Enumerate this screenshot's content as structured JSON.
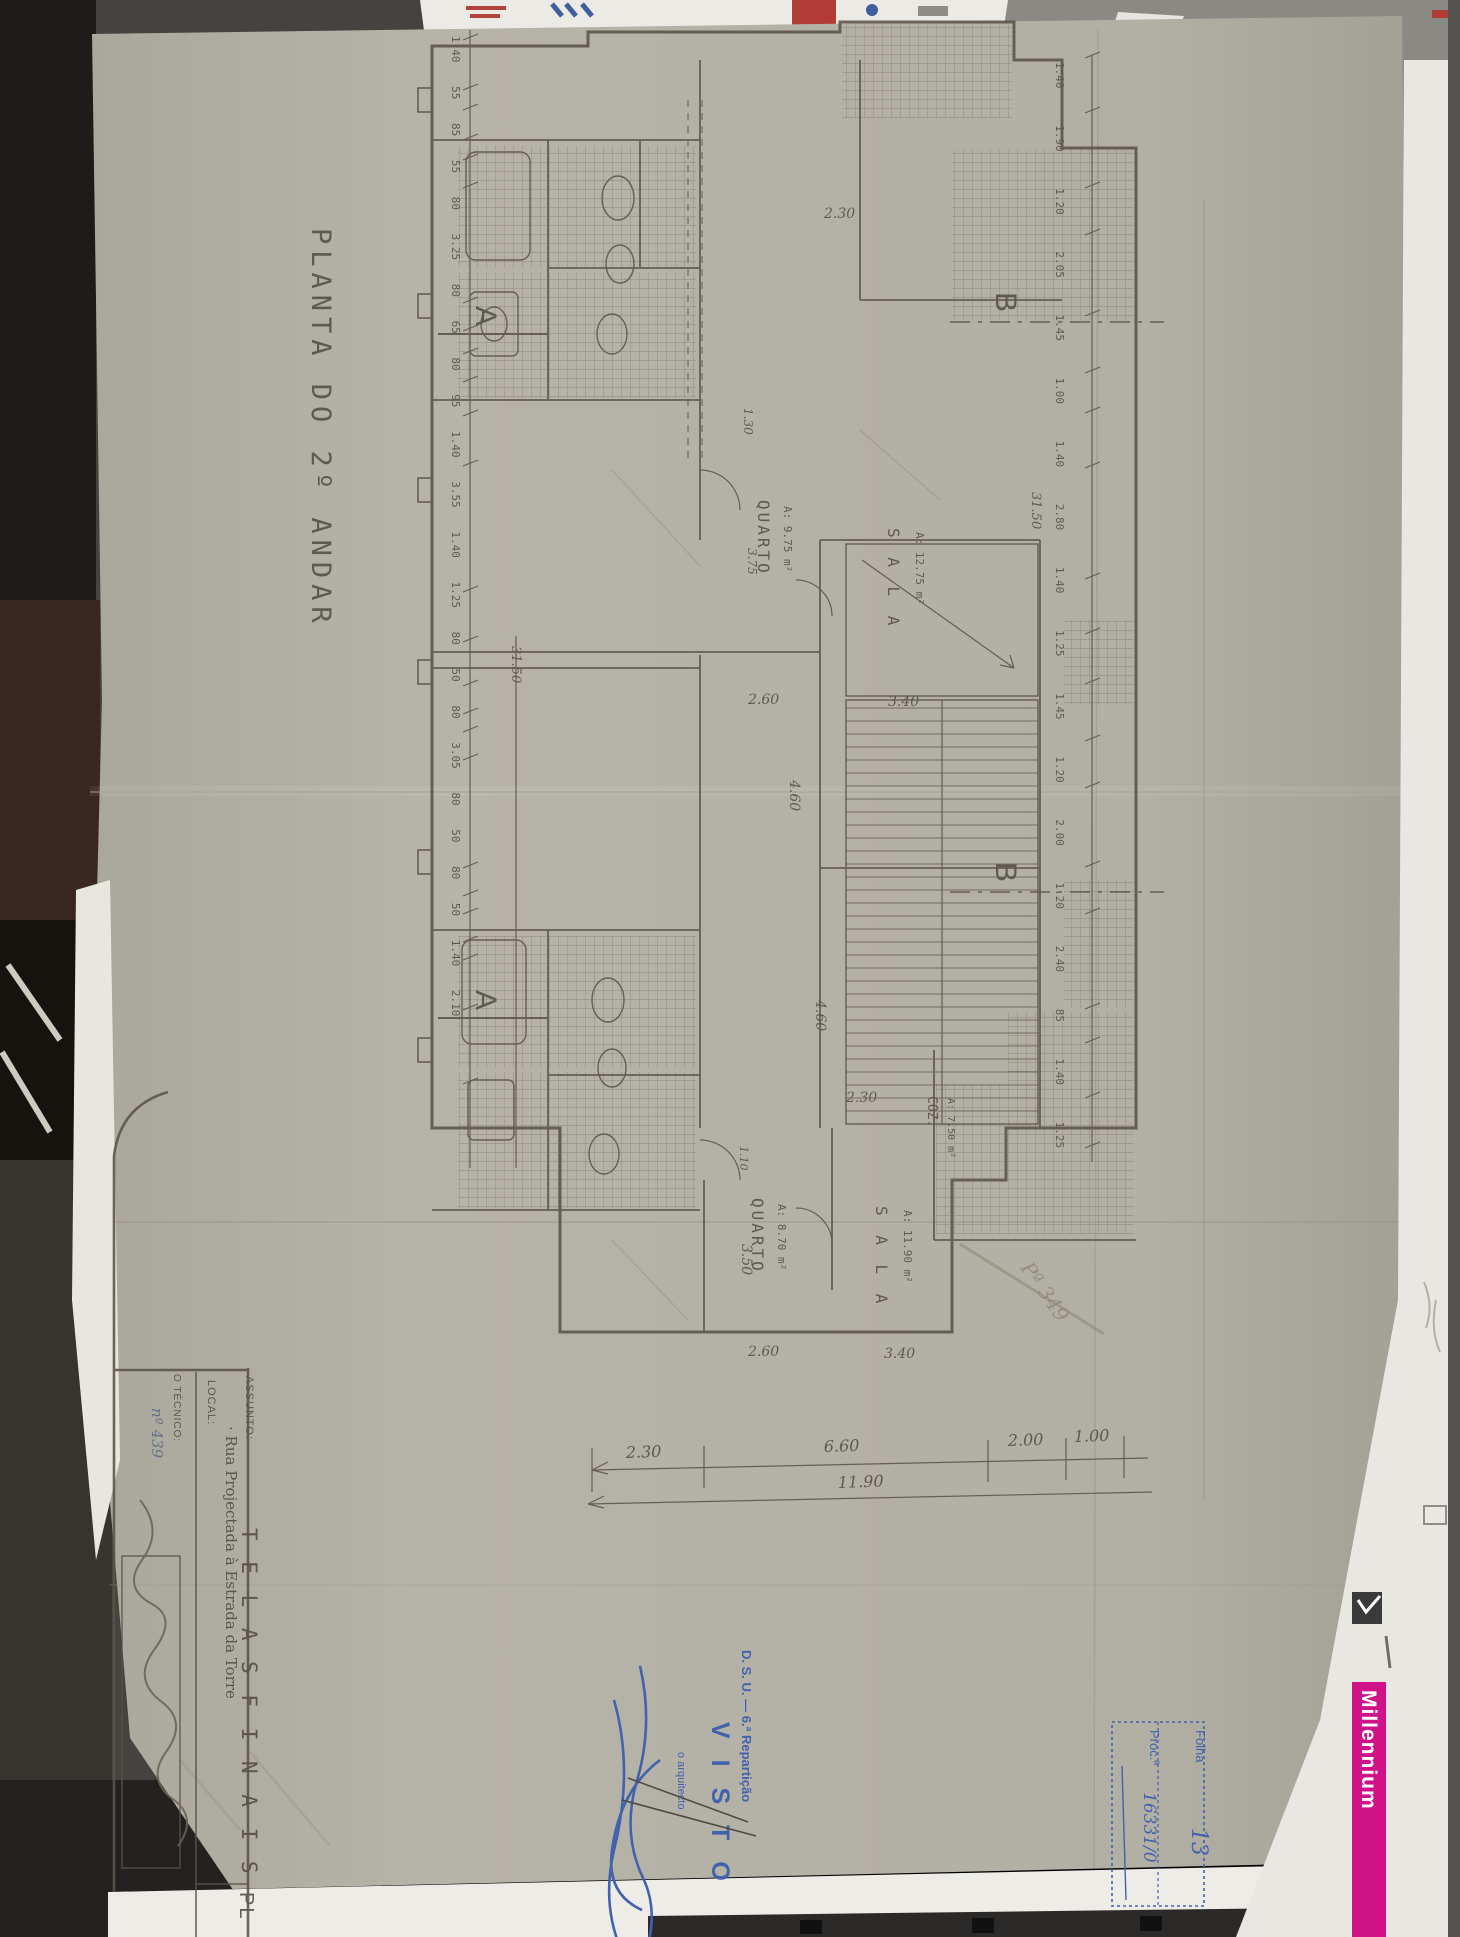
{
  "doc": {
    "title": "PLANTA  DO  2º  ANDAR",
    "title_block": {
      "assunto_label": "ASSUNTO:",
      "assunto_value": "T E L A S   F I N A I S",
      "local_label": "LOCAL:",
      "local_value": "· Rua Projectada à Estrada da Torre",
      "tecnico_label": "O TÉCNICO:",
      "tecnico_number": "nº 439",
      "sheet_label": "PL"
    },
    "rooms": {
      "q1_name": "QUARTO",
      "q1_area": "A: 9.75 m²",
      "s1_name": "S A L A",
      "s1_area": "A: 12.75 m²",
      "q2_name": "QUARTO",
      "q2_area": "A: 8.70 m²",
      "s2_name": "S A L A",
      "s2_area": "A: 11.90 m²",
      "coz_name": "COZ.",
      "coz_area": "A: 7.50 m²"
    },
    "sections": {
      "a": "A",
      "b": "B"
    },
    "dims": {
      "left_chain": "1.40 55 85 55 80 3.25 80 65 80 95 1.40 3.55 1.40 1.25 80 50 80 3.05 80 50 80 50 1.40 2.10",
      "left_total": "31.50",
      "right_chain": "1.40 1.90 1.20 2.05 1.45 1.00 1.40 2.80 1.40 1.25 1.45 1.20 2.00 1.20 2.40 85 1.40 1.25",
      "right_total": "31.50",
      "bottom": {
        "d1": "2.30",
        "d2": "6.60",
        "d3": "2.00",
        "d4": "1.00",
        "total": "11.90"
      },
      "internal": {
        "i1": "2.30",
        "i2": "2.60",
        "i3": "3.40",
        "i4": "4.60",
        "i5": "1.30",
        "i6": "3.75",
        "i7": "2.30",
        "i8": "4.60",
        "i9": "3.50",
        "i10": "2.60",
        "i11": "3.40",
        "i12": "1.10"
      }
    },
    "pencil_note": "Pª 349"
  },
  "stamps": {
    "approval": {
      "dept": "D. S. U. — 6.ª Repartição",
      "visto": "V I S T O",
      "role": "o arquitecto"
    },
    "file_box": {
      "folha_label": "Folha",
      "folha_value": "13",
      "proc_label": "Proc.ª",
      "proc_value": "16331/0"
    },
    "stamp_color": "#4262ae"
  },
  "edge": {
    "brand": "Millennium",
    "brand_color": "#cf1287",
    "page_digit": "2"
  }
}
